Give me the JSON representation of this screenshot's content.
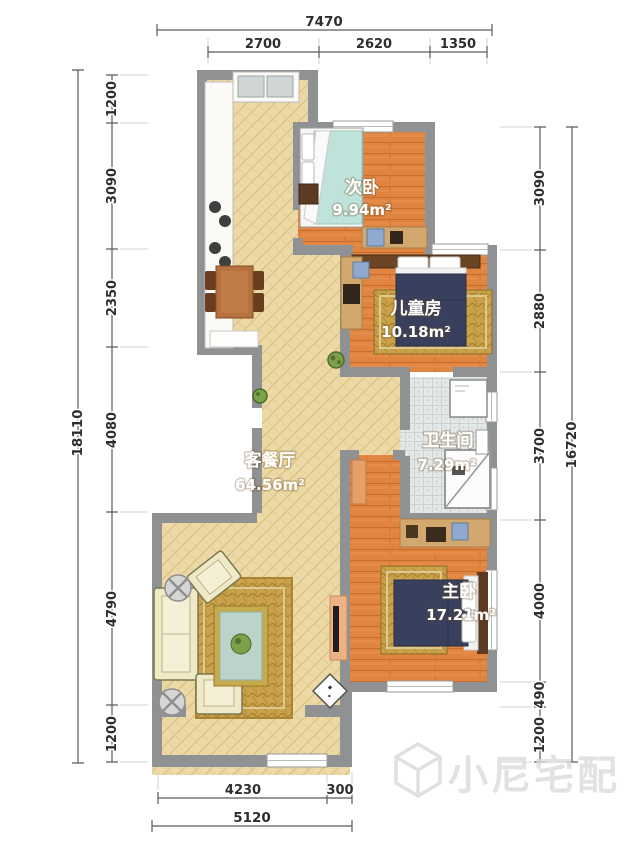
{
  "plan": {
    "rooms": [
      {
        "name": "次卧",
        "area": "9.94",
        "unit": "m²"
      },
      {
        "name": "儿童房",
        "area": "10.18",
        "unit": "m²"
      },
      {
        "name": "卫生间",
        "area": "7.29",
        "unit": "m²"
      },
      {
        "name": "客餐厅",
        "area": "64.56",
        "unit": "m²"
      },
      {
        "name": "主卧",
        "area": "17.21",
        "unit": "m²"
      }
    ]
  },
  "dimensions": {
    "top": {
      "overall": "7470",
      "segments": [
        "2700",
        "2620",
        "1350"
      ]
    },
    "left": {
      "overall": "18110",
      "segments": [
        "1200",
        "3090",
        "2350",
        "4080",
        "4790",
        "1200"
      ]
    },
    "right": {
      "overall": "16720",
      "segments": [
        "3090",
        "2880",
        "3700",
        "4000",
        "490",
        "1200"
      ]
    },
    "bottom": {
      "overall": "5120",
      "segments": [
        "4230",
        "300"
      ]
    }
  },
  "watermark": {
    "text": "小尼宅配"
  },
  "colors": {
    "wall": "#8f9193",
    "hatch_floor": "#ecd9a6",
    "wood_floor": "#e08440",
    "tile_floor": "#e4e8e7",
    "rug": "#c9a24b",
    "bed_dark": "#39405e",
    "bed_teal": "#bfe3da",
    "dim_text": "#2e2e2e",
    "watermark": "#dcdcdc"
  }
}
